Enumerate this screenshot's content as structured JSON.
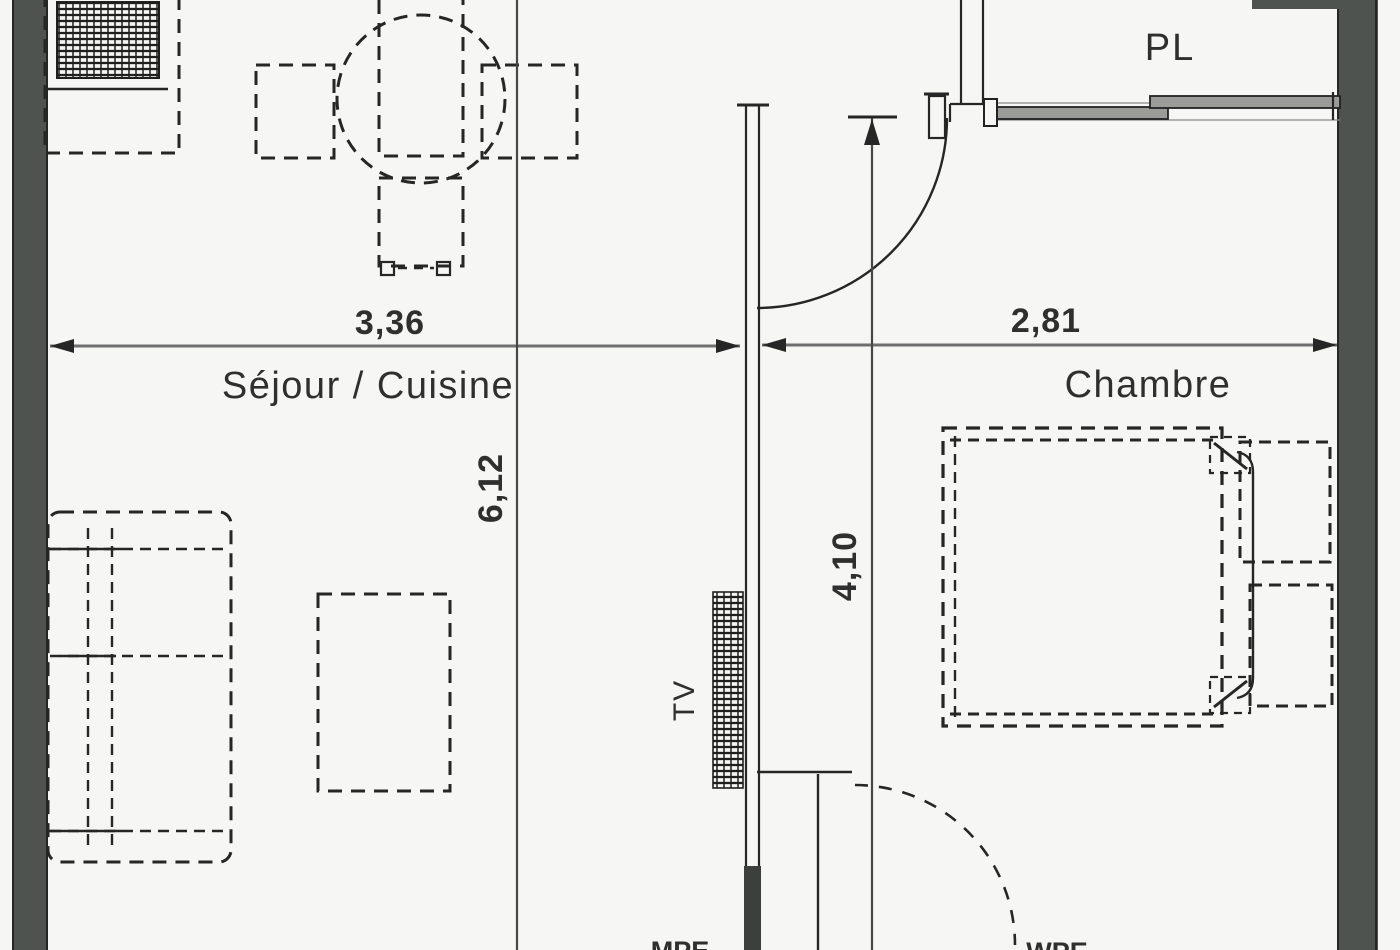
{
  "rooms": {
    "living_kitchen": "Séjour / Cuisine",
    "bedroom": "Chambre",
    "closet": "PL"
  },
  "dimensions": {
    "living_width": "3,36",
    "bedroom_width": "2,81",
    "living_length": "6,12",
    "bedroom_length": "4,10"
  },
  "annotations": {
    "tv": "TV",
    "bottom_left_clipped": "MPE",
    "bottom_right_clipped": "WPE"
  },
  "furniture_icons": [
    "kitchen-unit-icon",
    "dining-table-icon",
    "dining-chair-icon",
    "sofa-icon",
    "coffee-table-icon",
    "tv-unit-icon",
    "bed-icon",
    "pillow-icon",
    "nightstand-icon",
    "door-swing-icon",
    "sliding-door-icon"
  ],
  "colors": {
    "background": "#f6f6f4",
    "line": "#262626",
    "wall": "#4e534f",
    "wall_dark": "#3c403d",
    "dim_line": "#6f6f6f",
    "dim_line_dark": "#474747",
    "door_panel": "#9b9b98",
    "text": "#2f2f2f"
  }
}
